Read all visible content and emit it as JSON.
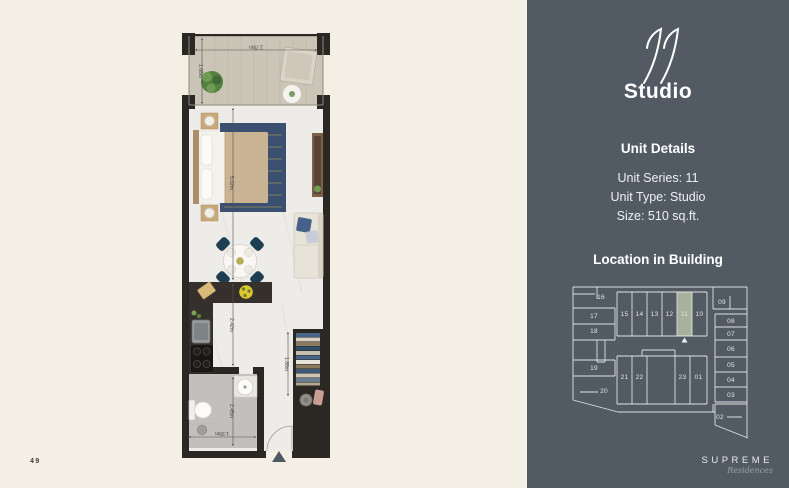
{
  "page": {
    "number": "49"
  },
  "brand": {
    "name": "SUPREME",
    "script": "Residences"
  },
  "panel": {
    "series_script": "11",
    "title": "Studio",
    "details_heading": "Unit Details",
    "details": {
      "series": "Unit Series: 11",
      "type": "Unit Type: Studio",
      "size": "Size: 510 sq.ft."
    },
    "location_heading": "Location in Building"
  },
  "plan": {
    "dims": {
      "balcony_width": "2.78m",
      "balcony_depth": "1.68m",
      "room_length": "5.02m",
      "kitchen_length": "2.42m",
      "bath_length": "2.45m",
      "bath_width": "1.99m",
      "wardrobe_length": "1.88m"
    }
  },
  "building": {
    "highlighted_unit": "11",
    "highlight_color": "#a8b19b",
    "units": [
      "16",
      "17",
      "18",
      "19",
      "20",
      "15",
      "14",
      "13",
      "12",
      "11",
      "10",
      "09",
      "08",
      "07",
      "06",
      "05",
      "04",
      "03",
      "02",
      "21",
      "22",
      "23",
      "01"
    ]
  },
  "colors": {
    "left_bg": "#f4efe5",
    "right_bg": "#525b64",
    "accent_sage": "#a8b19b",
    "plan_wall": "#2b2723",
    "rug_navy": "#3b5070"
  }
}
